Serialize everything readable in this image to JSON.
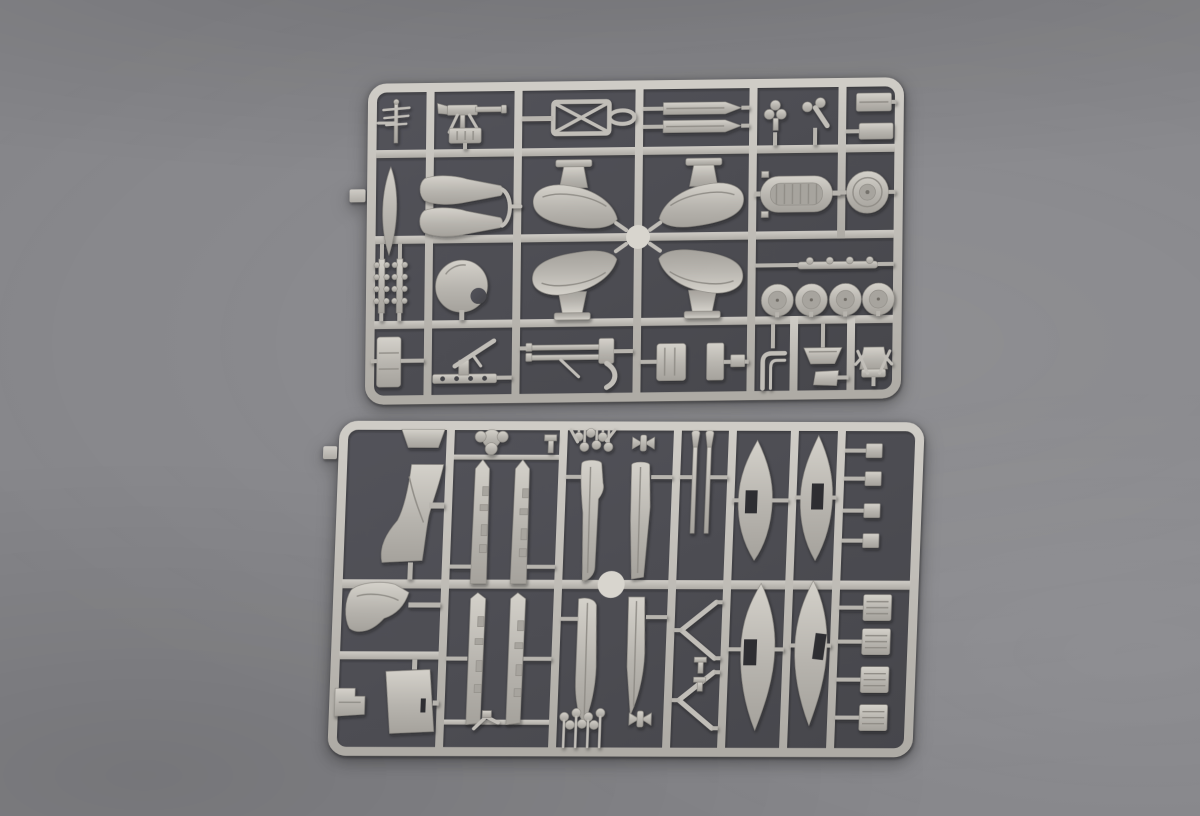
{
  "scene": {
    "description": "Product photograph of two light grey injection-moulded plastic model kit sprues (part runners) laid on a dark grey textured backdrop, photographed from slightly above",
    "subject": "plastic model kit sprues",
    "sprue_count": 2,
    "visible_text": ""
  },
  "colors": {
    "backdrop": "#86868a",
    "backdrop_light": "#97979b",
    "backdrop_dark": "#6e6e72",
    "sprue_interior": "#53535a",
    "sprue_interior_dark": "#46464b",
    "plastic": "#c3c0ba",
    "plastic_light": "#d4d1ca",
    "plastic_mid": "#b7b4ae",
    "plastic_dark": "#9a978f",
    "cutout": "#2e2e31"
  },
  "sprues": [
    {
      "id": "sprue-top",
      "position": "upper",
      "grid": "4 rows of cells with moulded rails",
      "parts": [
        "antenna mast",
        "machine gun",
        "ammunition box",
        "bomb rack frame with X bracing",
        "two long slat strips",
        "propeller boss parts",
        "small hatch rectangles",
        "vertical blade float",
        "two float top paddles",
        "four wing-float halves with pylons",
        "ribbed engine hull oval",
        "cowling ring disc",
        "two depth-charge cluster strips",
        "dome cowling",
        "four wheel domes",
        "hinge strip",
        "equipment block",
        "machine gun on pedestal mount",
        "twin machine gun",
        "hatch rectangles",
        "windscreen frame",
        "boat-shaped seat",
        "seat plate",
        "crew seat with frame"
      ]
    },
    {
      "id": "sprue-bottom",
      "position": "lower",
      "grid": "2 rows by 6 columns of cells with moulded rails",
      "parts": [
        "small trapezoid plate",
        "boot-shaped cowl section",
        "curved wedge cowl",
        "stepped block",
        "trapezoid panel with slot",
        "propeller boss",
        "small clip",
        "four hull side strips",
        "four float deck paddles",
        "bomb cluster x2",
        "bowtie clips",
        "two strut rods",
        "two V-struts",
        "small T-clips",
        "four float halves with dark rectangular openings",
        "four small hatch squares",
        "four ribbed radiator blocks"
      ]
    }
  ]
}
